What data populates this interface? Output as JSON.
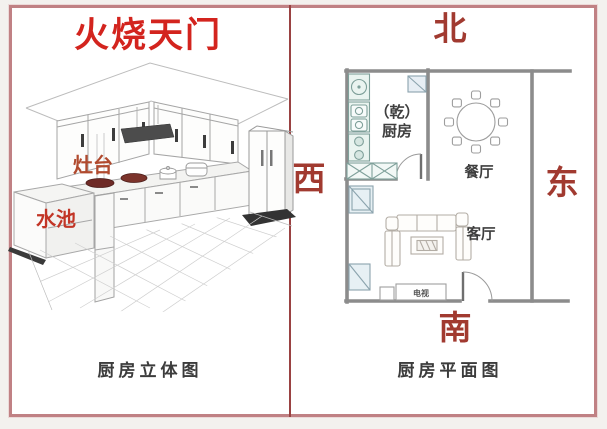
{
  "title": "火烧天门",
  "left_panel": {
    "caption": "厨房立体图",
    "stove_label": "灶台",
    "sink_label": "水池"
  },
  "right_panel": {
    "caption": "厨房平面图",
    "directions": {
      "north": "北",
      "south": "南",
      "east": "东",
      "west": "西"
    },
    "rooms": {
      "kitchen_line1": "（乾）",
      "kitchen_line2": "厨房",
      "dining": "餐厅",
      "living": "客厅",
      "tv": "电视"
    }
  },
  "colors": {
    "frame_border": "#c08184",
    "panel_divider": "#9a4242",
    "title_red": "#d3241e",
    "direction_red": "#a13a30",
    "stove_label_red": "#b14a2e",
    "sink_label_red": "#c23526",
    "wall_gray": "#8c8c8c",
    "fixture_teal_fill": "#eaf4f0",
    "pan_dark_red": "#6e2a26"
  }
}
